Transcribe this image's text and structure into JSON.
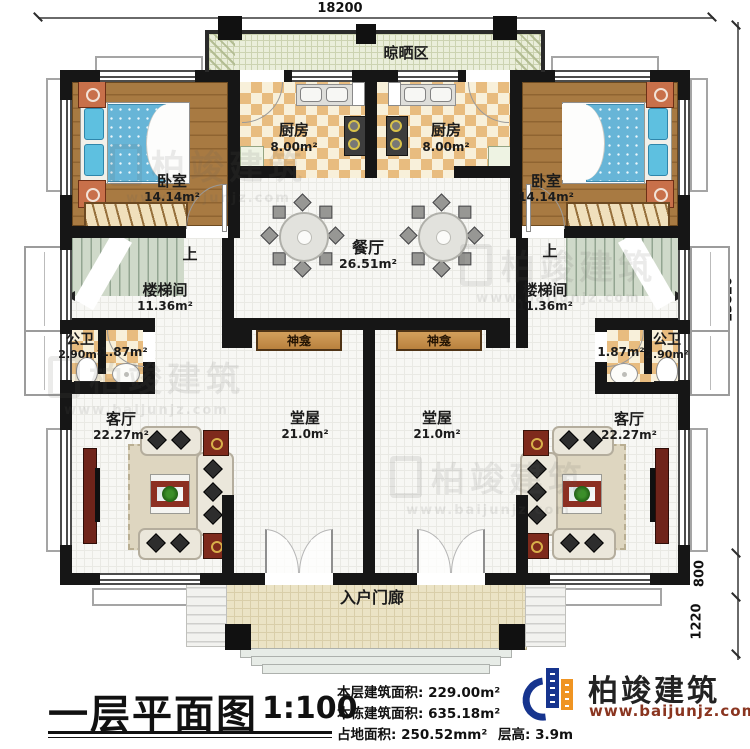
{
  "dimensions": {
    "top_width": "18200",
    "right_height_main": "13820",
    "right_step": "800",
    "right_porch": "1220"
  },
  "rooms": {
    "drying_area": {
      "name": "晾晒区"
    },
    "kitchen_left": {
      "name": "厨房",
      "area": "8.00m²"
    },
    "kitchen_right": {
      "name": "厨房",
      "area": "8.00m²"
    },
    "bedroom_left": {
      "name": "卧室",
      "area": "14.14m²"
    },
    "bedroom_right": {
      "name": "卧室",
      "area": "14.14m²"
    },
    "dining": {
      "name": "餐厅",
      "area": "26.51m²"
    },
    "stair_left": {
      "name": "楼梯间",
      "area": "11.36m²",
      "up_label": "上"
    },
    "stair_right": {
      "name": "楼梯间",
      "area": "11.36m²",
      "up_label": "上"
    },
    "bath_left": {
      "name": "公卫",
      "area": "2.90m²",
      "vestibule_area": "1.87m²"
    },
    "bath_right": {
      "name": "公卫",
      "area": "2.90m²",
      "vestibule_area": "1.87m²"
    },
    "shrine_left": {
      "name": "神龛"
    },
    "shrine_right": {
      "name": "神龛"
    },
    "hall_left": {
      "name": "堂屋",
      "area": "21.0m²"
    },
    "hall_right": {
      "name": "堂屋",
      "area": "21.0m²"
    },
    "living_left": {
      "name": "客厅",
      "area": "22.27m²"
    },
    "living_right": {
      "name": "客厅",
      "area": "22.27m²"
    },
    "porch": {
      "name": "入户门廊"
    }
  },
  "titleblock": {
    "title": "一层平面图",
    "scale": "1:100",
    "info_lines": [
      "本层建筑面积: 229.00m²",
      "本栋建筑面积: 635.18m²",
      "占地面积: 250.52mm²"
    ],
    "floor_height": "层高: 3.9m",
    "brand": "柏竣建筑",
    "brand_url": "www.baijunjz.com"
  },
  "watermark": {
    "text": "柏竣建筑",
    "url": "www.baijunjz.com"
  },
  "colors": {
    "wall": "#161616",
    "wood_floor": "#a87a42",
    "checker_tan": "#e8bc7f",
    "stair_green": "#cfd9c9",
    "porch_beige": "#ebe3c5",
    "bed_blue": "#67b5d7",
    "logo_blue": "#16348e",
    "logo_orange": "#ef9422",
    "brand_url_red": "#8a3520"
  }
}
